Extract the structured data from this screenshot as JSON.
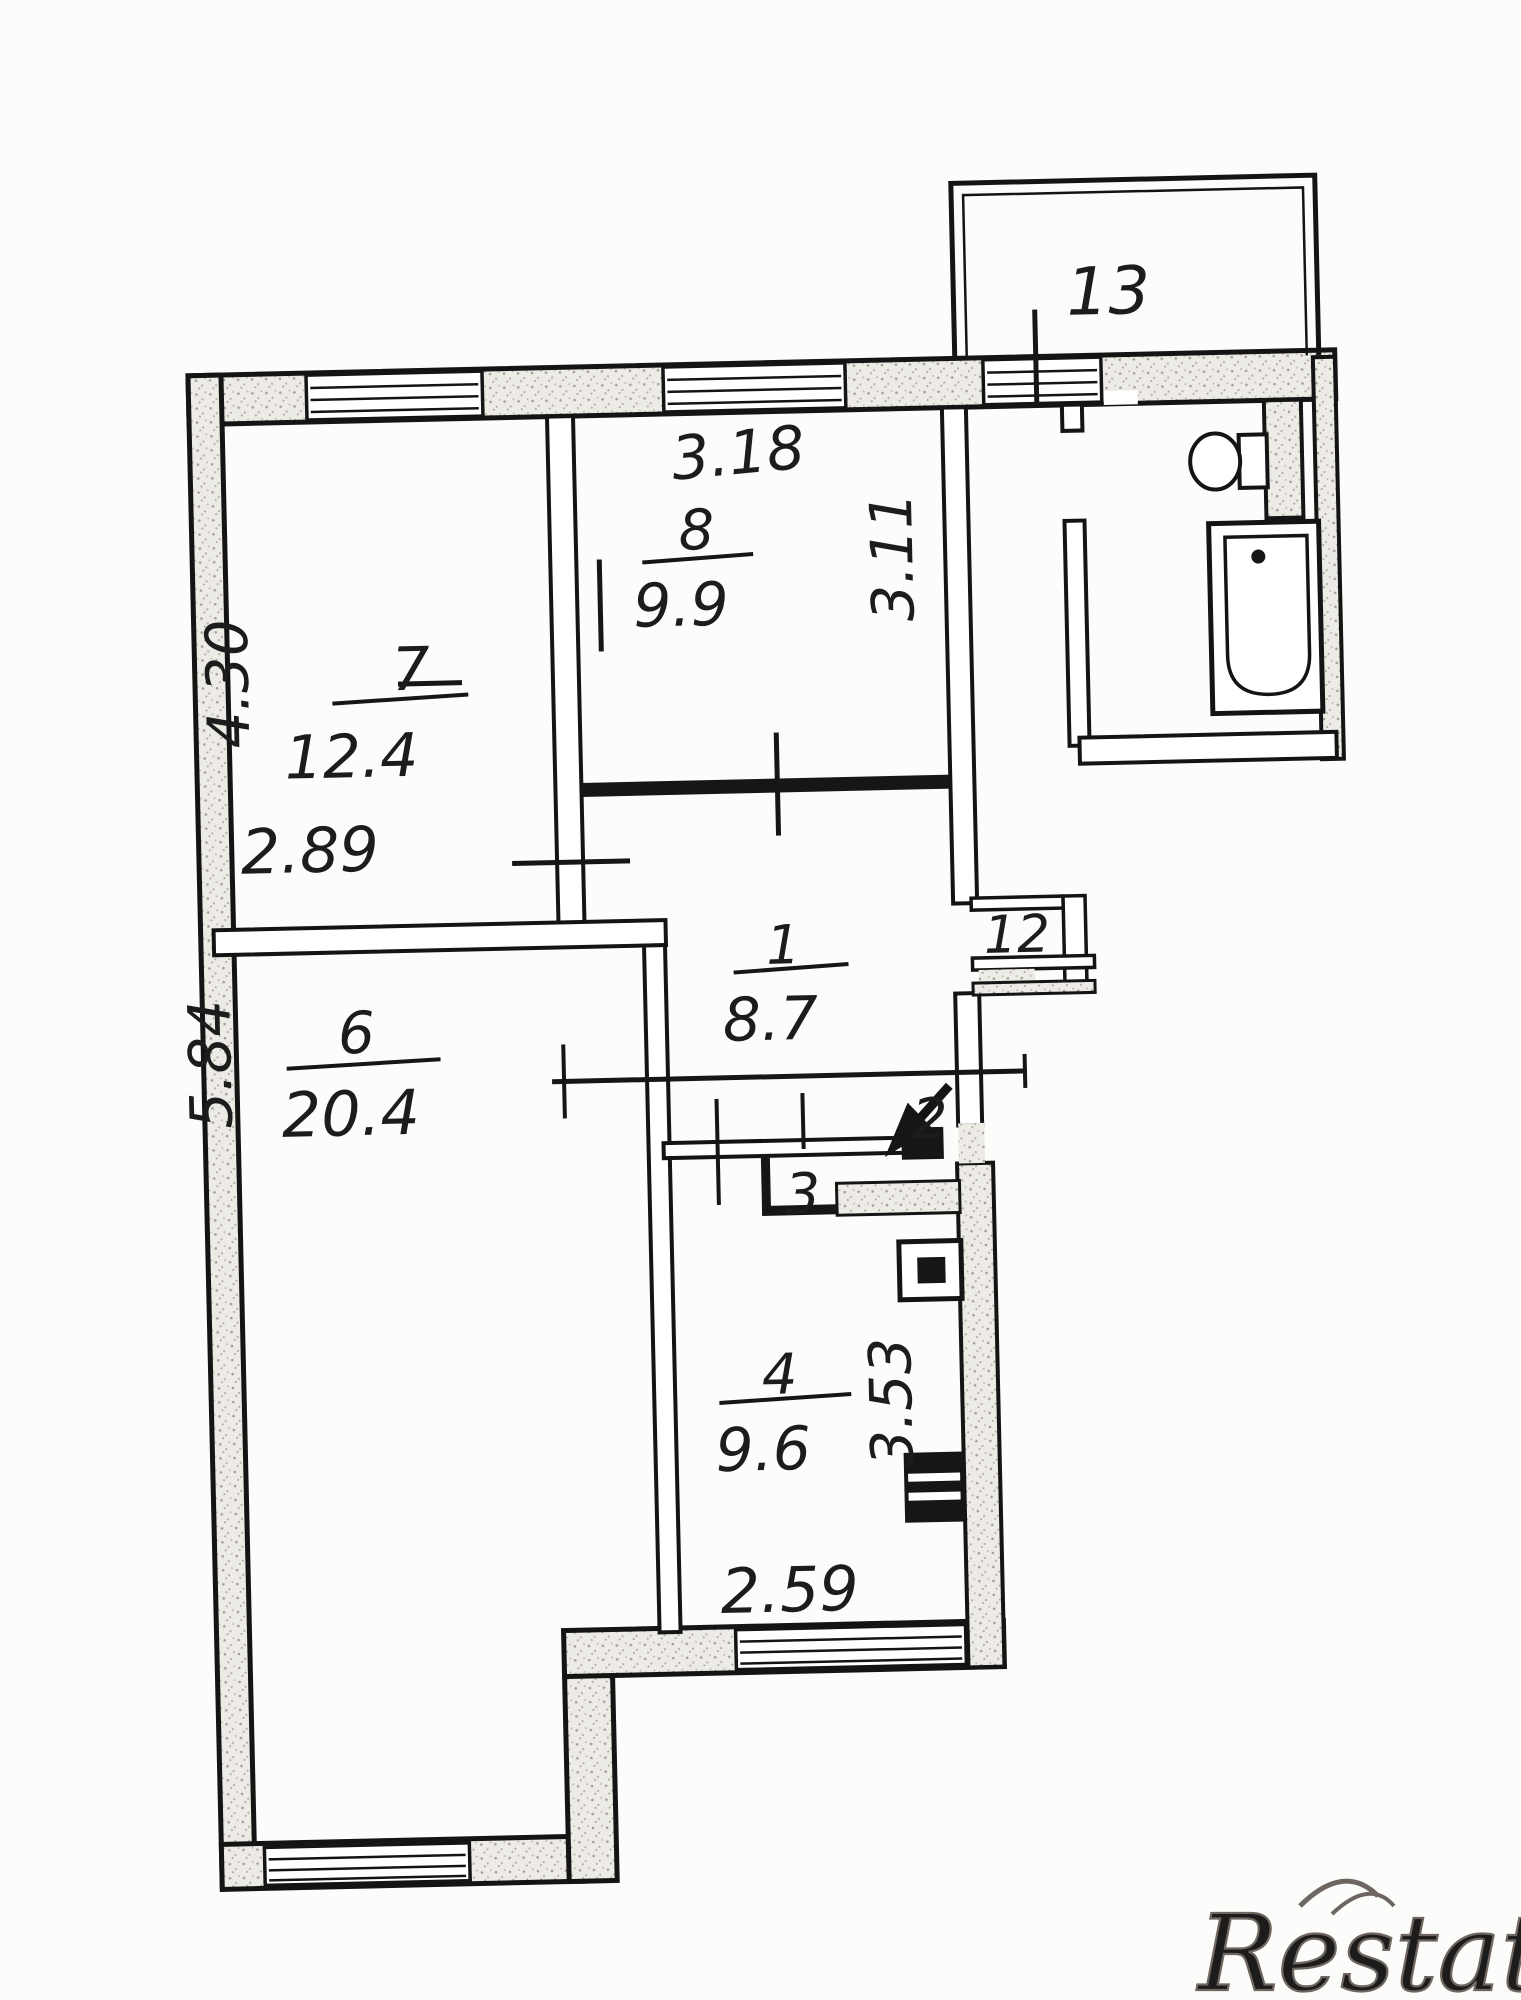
{
  "rooms": {
    "r1": {
      "number": "1",
      "area": "8.7"
    },
    "r2": {
      "number": "2"
    },
    "r3": {
      "number": "3"
    },
    "r4": {
      "number": "4",
      "area": "9.6"
    },
    "r6": {
      "number": "6",
      "area": "20.4"
    },
    "r7": {
      "number": "7",
      "area": "12.4"
    },
    "r8": {
      "number": "8",
      "area": "9.9"
    },
    "r12": {
      "number": "12"
    },
    "r13": {
      "number": "13"
    }
  },
  "dimensions": {
    "w318": "3.18",
    "h311": "3.11",
    "h430": "4.30",
    "w289": "2.89",
    "h584": "5.84",
    "h353": "3.53",
    "w259": "2.59"
  },
  "watermark": {
    "brand": "Restate"
  }
}
